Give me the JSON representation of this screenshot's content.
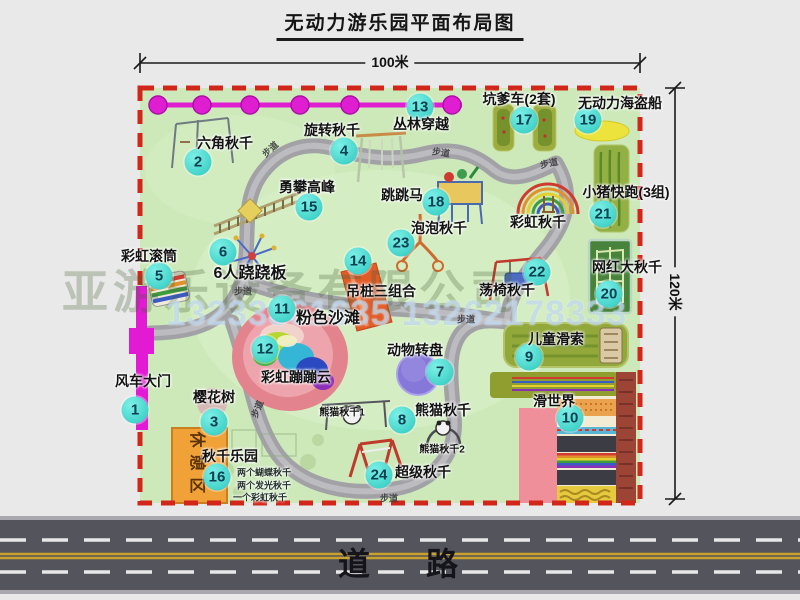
{
  "title": "无动力游乐园平面布局图",
  "dim_width": "100米",
  "dim_height": "120米",
  "road_label": "道路",
  "rest_area": "休憩区",
  "walkway": "步道",
  "watermark": {
    "company": "亚游乐设备有限公司",
    "phone": "13233861635 13262178333"
  },
  "colors": {
    "park_green": "#cde9ba",
    "path_gray": "#a2a2a6",
    "boundary_red": "#d3261b",
    "marker_teal": "#2cc8bf",
    "gate_magenta": "#e21ad4",
    "rest_orange": "#f0a238",
    "road_dark": "#54545c",
    "road_line_yellow": "#c9a22e"
  },
  "attractions": [
    {
      "num": "1",
      "label": "风车大门",
      "bx": 135,
      "by": 410,
      "lx": 143,
      "ly": 381
    },
    {
      "num": "2",
      "label": "六角秋千",
      "bx": 198,
      "by": 162,
      "lx": 225,
      "ly": 143
    },
    {
      "num": "3",
      "label": "樱花树",
      "bx": 214,
      "by": 422,
      "lx": 214,
      "ly": 397
    },
    {
      "num": "4",
      "label": "旋转秋千",
      "bx": 344,
      "by": 151,
      "lx": 332,
      "ly": 130
    },
    {
      "num": "5",
      "label": "彩虹滚筒",
      "bx": 159,
      "by": 276,
      "lx": 149,
      "ly": 256
    },
    {
      "num": "6",
      "label": "6人跷跷板",
      "bx": 223,
      "by": 252,
      "lx": 250,
      "ly": 271,
      "cls": "lbl-lg"
    },
    {
      "num": "7",
      "label": "动物转盘",
      "bx": 440,
      "by": 372,
      "lx": 415,
      "ly": 350
    },
    {
      "num": "8",
      "label": "熊猫秋千",
      "bx": 402,
      "by": 420,
      "lx": 443,
      "ly": 410
    },
    {
      "num": "9",
      "label": "儿童滑索",
      "bx": 529,
      "by": 357,
      "lx": 556,
      "ly": 339
    },
    {
      "num": "10",
      "label": "滑世界",
      "bx": 570,
      "by": 418,
      "lx": 554,
      "ly": 401
    },
    {
      "num": "11",
      "label": "粉色沙滩",
      "bx": 282,
      "by": 309,
      "lx": 328,
      "ly": 316,
      "cls": "lbl-lg"
    },
    {
      "num": "12",
      "label": "彩虹蹦蹦云",
      "bx": 265,
      "by": 349,
      "lx": 296,
      "ly": 377
    },
    {
      "num": "13",
      "label": "丛林穿越",
      "bx": 420,
      "by": 107,
      "lx": 421,
      "ly": 124
    },
    {
      "num": "14",
      "label": "吊桩三组合",
      "bx": 358,
      "by": 261,
      "lx": 381,
      "ly": 291
    },
    {
      "num": "15",
      "label": "勇攀高峰",
      "bx": 309,
      "by": 207,
      "lx": 307,
      "ly": 187
    },
    {
      "num": "16",
      "label": "秋千乐园",
      "bx": 217,
      "by": 477,
      "lx": 230,
      "ly": 456
    },
    {
      "num": "17",
      "label": "坑爹车(2套)",
      "bx": 524,
      "by": 120,
      "lx": 519,
      "ly": 99
    },
    {
      "num": "18",
      "label": "跳跳马",
      "bx": 436,
      "by": 202,
      "lx": 402,
      "ly": 195
    },
    {
      "num": "19",
      "label": "无动力海盗船",
      "bx": 588,
      "by": 120,
      "lx": 620,
      "ly": 103
    },
    {
      "num": "20",
      "label": "网红大秋千",
      "bx": 609,
      "by": 294,
      "lx": 627,
      "ly": 267
    },
    {
      "num": "21",
      "label": "小猪快跑(3组)",
      "bx": 603,
      "by": 214,
      "lx": 626,
      "ly": 192
    },
    {
      "num": "22",
      "label": "荡椅秋千",
      "bx": 537,
      "by": 272,
      "lx": 507,
      "ly": 290
    },
    {
      "num": "23",
      "label": "泡泡秋千",
      "bx": 401,
      "by": 243,
      "lx": 439,
      "ly": 228
    },
    {
      "num": "24",
      "label": "超级秋千",
      "bx": 379,
      "by": 475,
      "lx": 423,
      "ly": 472
    }
  ],
  "extra_labels": [
    {
      "text": "彩虹秋千",
      "x": 538,
      "y": 222,
      "cls": "lbl"
    },
    {
      "text": "熊猫秋千1",
      "x": 342,
      "y": 411,
      "cls": "lbl-sm"
    },
    {
      "text": "熊猫秋千2",
      "x": 442,
      "y": 448,
      "cls": "lbl-sm"
    },
    {
      "text": "两个蝴蝶秋千",
      "x": 264,
      "y": 472,
      "cls": "lbl-xs"
    },
    {
      "text": "两个发光秋千",
      "x": 264,
      "y": 485,
      "cls": "lbl-xs"
    },
    {
      "text": "一个彩虹秋千",
      "x": 260,
      "y": 497,
      "cls": "lbl-xs"
    }
  ],
  "walkway_labels": [
    {
      "x": 270,
      "y": 149,
      "rot": -42
    },
    {
      "x": 441,
      "y": 152,
      "rot": 8
    },
    {
      "x": 549,
      "y": 163,
      "rot": -12
    },
    {
      "x": 243,
      "y": 291,
      "rot": 0
    },
    {
      "x": 466,
      "y": 319,
      "rot": 0
    },
    {
      "x": 257,
      "y": 409,
      "rot": -68
    },
    {
      "x": 389,
      "y": 498,
      "rot": 0
    }
  ]
}
